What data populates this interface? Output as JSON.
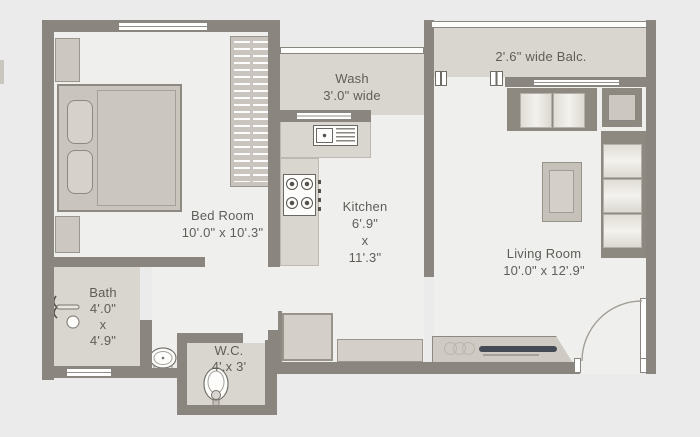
{
  "rooms": {
    "bedroom": {
      "name": "Bed Room",
      "dims": "10'.0\" x 10'.3\""
    },
    "wash": {
      "name": "Wash",
      "dims": "3'.0\" wide"
    },
    "kitchen": {
      "name": "Kitchen",
      "width": "6'.9\"",
      "sep": "x",
      "depth": "11'.3\""
    },
    "balcony": {
      "name": "2'.6\" wide Balc."
    },
    "living": {
      "name": "Living Room",
      "dims": "10'.0\" x 12'.9\""
    },
    "bath": {
      "name": "Bath",
      "width": "4'.0\"",
      "sep": "x",
      "depth": "4'.9\""
    },
    "wc": {
      "name": "W.C.",
      "dims": "4'.x 3'"
    }
  },
  "colors": {
    "background": "#ebebeb",
    "wall": "#8a857f",
    "floor_light": "#eff0ee",
    "floor_service": "#d9d6d0",
    "furniture": "#ccc8c1",
    "tv_accent": "#454a57",
    "label_text": "#605d58"
  }
}
